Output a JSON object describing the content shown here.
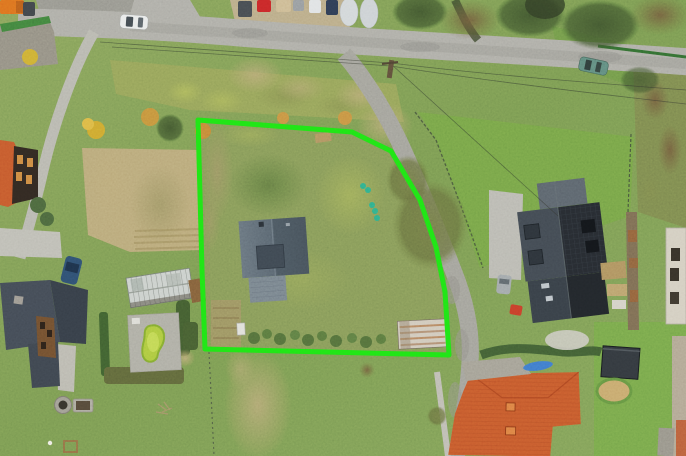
{
  "image": {
    "kind": "aerial-drone-photograph",
    "description": "Top-down aerial view of a village building plot outlined with a bright green boundary overlay, surrounded by neighbouring houses, gardens, lanes and a main road",
    "overlay": {
      "name": "property-boundary",
      "color": "#1de214",
      "stroke_width": 5
    },
    "palette": {
      "grass": "#79954f",
      "lawn_bright": "#6f9c44",
      "road": "#a7a6a1",
      "lane": "#9b9a94",
      "dirt": "#b3a173",
      "dark_roof": "#24282e",
      "slate_roof": "#545f6a",
      "orange_roof": "#c0542b",
      "red_tile_roof": "#c2552b",
      "pool_water": "#a6c43d",
      "greenhouse": "#c6cbc8",
      "boundary_green": "#1de214"
    },
    "objects": [
      "main road with white car",
      "teal car on descending road",
      "row of parked cars",
      "outlined plot with meadow and shrubs",
      "grey slate-roof house inside the plot",
      "rusty corrugated shed inside the plot",
      "neighbour house with solar panels and dormers",
      "glass greenhouse",
      "kidney-shaped garden pool on paved terrace",
      "red tile roof farmhouse",
      "orange roof barn house with dark timber wall",
      "dark flat-roof garage with round sand pit"
    ]
  }
}
